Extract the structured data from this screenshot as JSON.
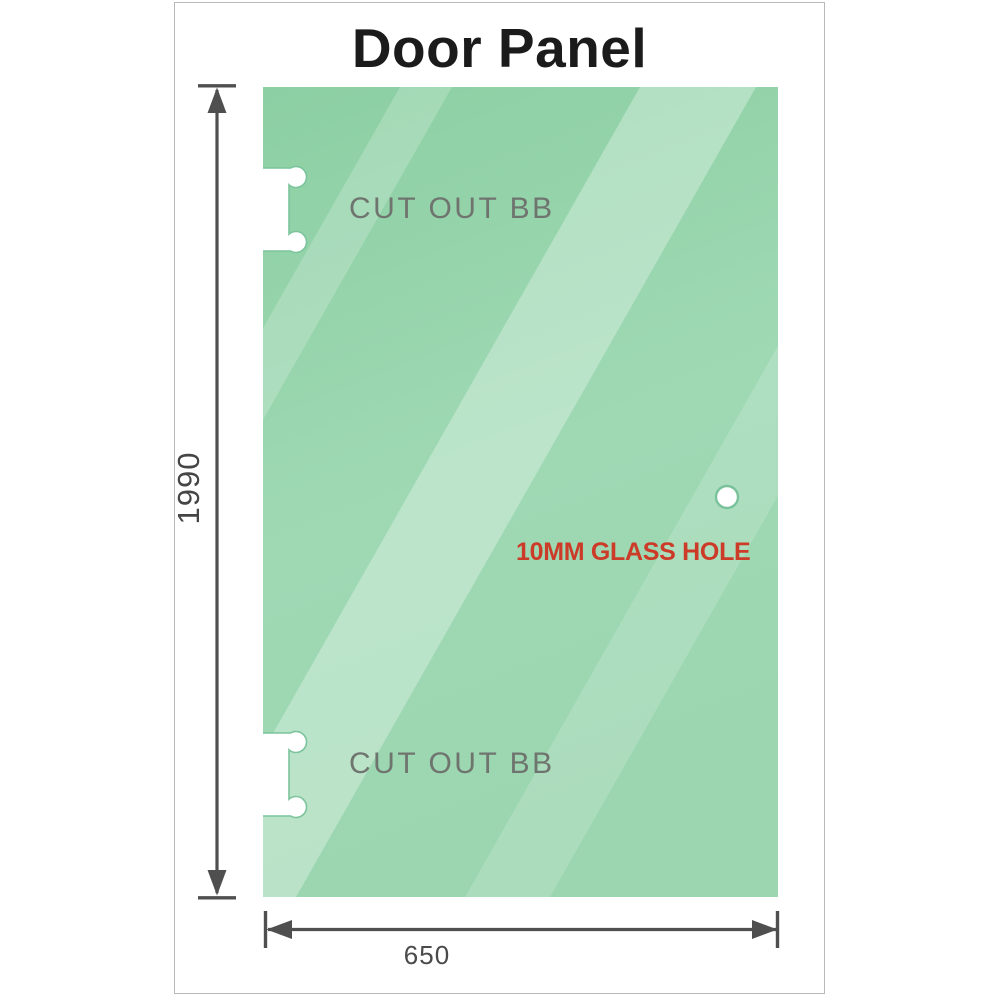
{
  "title": "Door Panel",
  "panel": {
    "height_label": "1990",
    "width_label": "650",
    "cutout_top_label": "CUT OUT BB",
    "cutout_bottom_label": "CUT OUT BB",
    "hole_label": "10MM GLASS HOLE"
  },
  "colors": {
    "glass_base": "#8ccfa3",
    "glass_mid": "#9fd9b4",
    "glass_bottom": "#9bd6b0",
    "glass_reflection": "#ffffff",
    "cutout_outline": "#7cc49c",
    "dimension_gray": "#4f4f4f",
    "cutout_label_gray": "#6f746f",
    "hole_label_red": "#cc3a28",
    "card_border": "#b9b9b9",
    "title_color": "#1b1b1b"
  }
}
